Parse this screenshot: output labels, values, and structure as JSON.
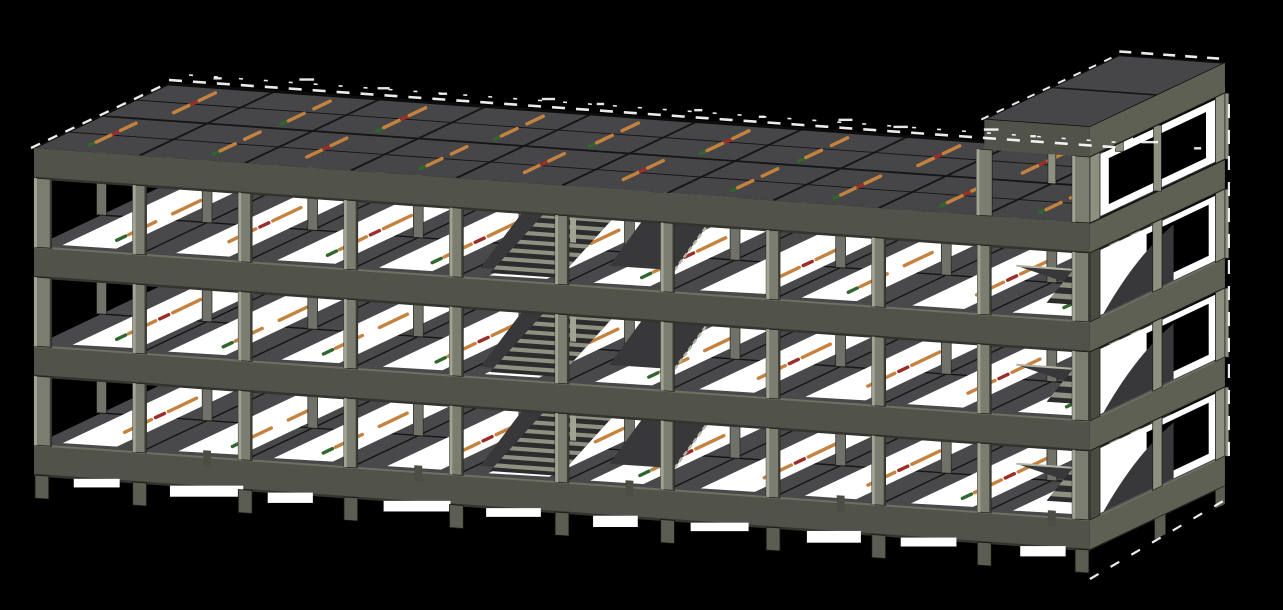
{
  "scene": {
    "model_type": "reinforced-concrete-frame-3d-model",
    "background": "#000000",
    "viewport": {
      "width": 1283,
      "height": 610
    }
  },
  "building": {
    "stories_main": 3,
    "stories_tower": 4,
    "bays_length": 10,
    "bays_depth": 2,
    "length_px": 1072,
    "story_height_px": 99,
    "beam_depth_px": 30,
    "tower_start_bay": 9,
    "stair_bays": [
      4,
      5
    ],
    "tower_has_stair": true,
    "foundation_stubs": true
  },
  "colors": {
    "background": "#000000",
    "showthrough": "#ffffff",
    "slab_top": "#49494c",
    "roof_top": "#464649",
    "slab_joint": "#151515",
    "band_face": "#51524a",
    "band_face_light": "#5e6053",
    "band_top": "#6e7062",
    "band_shadow": "#33342d",
    "col_face": "#7b7d70",
    "col_light": "#a1a393",
    "col_dark": "#3c3d36",
    "col_back": "#8d8f80",
    "col_mid": "#70726a",
    "stub": "#5c5d52",
    "stub_mid": "#4c4d44",
    "landing": "#717368",
    "stair_dark": "#2c2c2e",
    "stair_light": "#8e9181",
    "stringer": "#b2b4a3",
    "wedge": "#38383b",
    "edge": "#111111"
  },
  "slab_marks": {
    "colors": {
      "orange": "#c5823f",
      "red": "#9c2d28",
      "green": "#2f672d"
    },
    "segments": [
      {
        "color": "green",
        "t0": 0.06,
        "t1": 0.15
      },
      {
        "color": "orange",
        "t0": 0.18,
        "t1": 0.45
      },
      {
        "color": "red",
        "t0": 0.49,
        "t1": 0.58
      },
      {
        "color": "orange",
        "t0": 0.62,
        "t1": 0.9
      }
    ]
  }
}
